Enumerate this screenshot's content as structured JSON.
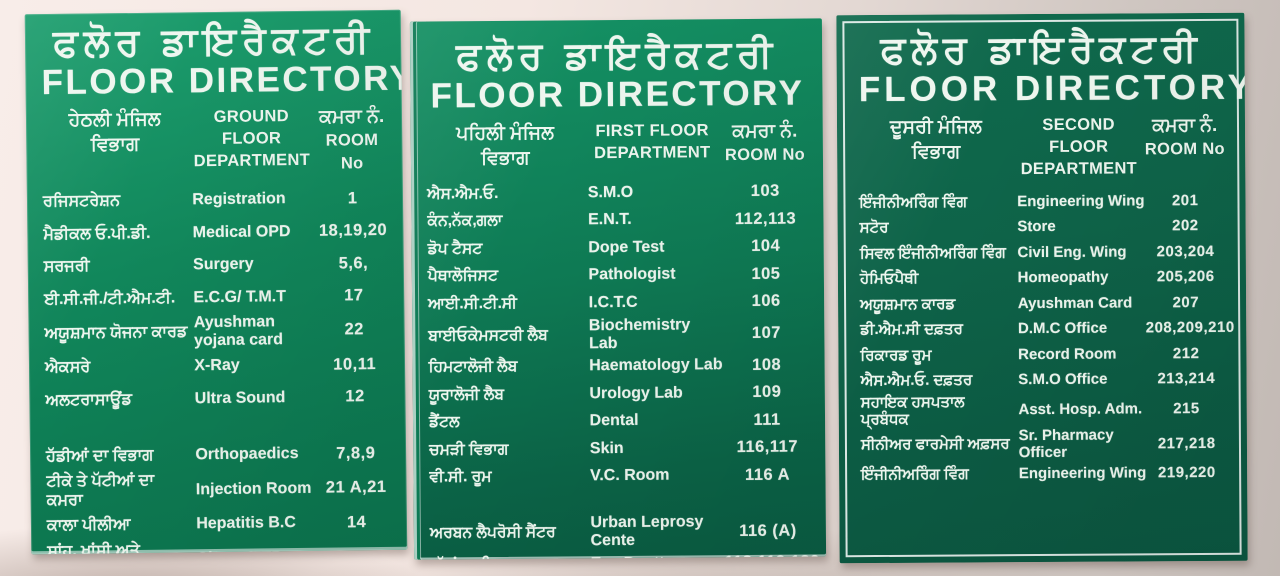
{
  "colors": {
    "board1_green": "#11875b",
    "board2_green": "#0e7a54",
    "board3_green": "#0c5b43",
    "text_white": "#eef6ef",
    "wall_pink": "#f4e7e2"
  },
  "boards": [
    {
      "title_punjabi": "ਫਲੋਰ ਡਾਇਰੈਕਟਰੀ",
      "title_english": "FLOOR DIRECTORY",
      "header": {
        "floor_punjabi": "ਹੇਠਲੀ ਮੰਜਿਲ",
        "dept_punjabi": "ਵਿਭਾਗ",
        "floor_english": "GROUND FLOOR",
        "dept_english": "DEPARTMENT",
        "room_punjabi": "ਕਮਰਾ ਨੰ.",
        "room_english": "ROOM No"
      },
      "rows": [
        {
          "punjabi": "ਰਜਿਸਟਰੇਸ਼ਨ",
          "department": "Registration",
          "room": "1"
        },
        {
          "punjabi": "ਮੈਡੀਕਲ ਓ.ਪੀ.ਡੀ.",
          "department": "Medical OPD",
          "room": "18,19,20"
        },
        {
          "punjabi": "ਸਰਜਰੀ",
          "department": "Surgery",
          "room": "5,6,"
        },
        {
          "punjabi": "ਈ.ਸੀ.ਜੀ./ਟੀ.ਐਮ.ਟੀ.",
          "department": "E.C.G/ T.M.T",
          "room": "17"
        },
        {
          "punjabi": "ਅਯੂਸ਼ਮਾਨ ਯੋਜਨਾ ਕਾਰਡ",
          "department": "Ayushman yojana card",
          "room": "22"
        },
        {
          "punjabi": "ਐਕਸਰੇ",
          "department": "X-Ray",
          "room": "10,11"
        },
        {
          "punjabi": "ਅਲਟਰਾਸਾਊਂਡ",
          "department": "Ultra Sound",
          "room": "12"
        },
        {
          "punjabi": "ਹੱਡੀਆਂ ਦਾ ਵਿਭਾਗ",
          "department": "Orthopaedics",
          "room": "7,8,9",
          "gap_before": true
        },
        {
          "punjabi": "ਟੀਕੇ ਤੇ ਪੱਟੀਆਂ ਦਾ ਕਮਰਾ",
          "department": "Injection Room",
          "room": "21 A,21"
        },
        {
          "punjabi": "ਕਾਲਾ ਪੀਲੀਆ",
          "department": "Hepatitis B.C",
          "room": "14"
        },
        {
          "punjabi": "ਸਾਂਹ, ਖਾਂਸੀ ਅਤੇ\nਟੀ.ਬੀ. ਦੇ ਰੋਗ",
          "department": "Chest & TB",
          "room": ""
        }
      ]
    },
    {
      "title_punjabi": "ਫਲੋਰ ਡਾਇਰੈਕਟਰੀ",
      "title_english": "FLOOR DIRECTORY",
      "header": {
        "floor_punjabi": "ਪਹਿਲੀ ਮੰਜਿਲ",
        "dept_punjabi": "ਵਿਭਾਗ",
        "floor_english": "FIRST FLOOR",
        "dept_english": "DEPARTMENT",
        "room_punjabi": "ਕਮਰਾ ਨੰ.",
        "room_english": "ROOM No"
      },
      "rows": [
        {
          "punjabi": "ਐਸ.ਐਮ.ਓ.",
          "department": "S.M.O",
          "room": "103"
        },
        {
          "punjabi": "ਕੰਨ,ਨੱਕ,ਗਲਾ",
          "department": "E.N.T.",
          "room": "112,113"
        },
        {
          "punjabi": "ਡੋਪ ਟੈਸਟ",
          "department": "Dope Test",
          "room": "104"
        },
        {
          "punjabi": "ਪੈਥਾਲੋਜਿਸਟ",
          "department": "Pathologist",
          "room": "105"
        },
        {
          "punjabi": "ਆਈ.ਸੀ.ਟੀ.ਸੀ",
          "department": "I.C.T.C",
          "room": "106"
        },
        {
          "punjabi": "ਬਾਈਓਕੇਮਸਟਰੀ ਲੈਬ",
          "department": "Biochemistry Lab",
          "room": "107"
        },
        {
          "punjabi": "ਹਿਮਟਾਲੋਜੀ ਲੈਬ",
          "department": "Haematology Lab",
          "room": "108"
        },
        {
          "punjabi": "ਯੂਰਾਲੋਜੀ ਲੈਬ",
          "department": "Urology Lab",
          "room": "109"
        },
        {
          "punjabi": "ਡੈਂਟਲ",
          "department": "Dental",
          "room": "111"
        },
        {
          "punjabi": "ਚਮੜੀ ਵਿਭਾਗ",
          "department": "Skin",
          "room": "116,117"
        },
        {
          "punjabi": "ਵੀ.ਸੀ. ਰੂਮ",
          "department": "V.C. Room",
          "room": "116 A"
        },
        {
          "punjabi": "ਅਰਬਨ ਲੈਪਰੋਸੀ ਸੈਂਟਰ",
          "department": "Urban Leprosy Cente",
          "room": "116 (A)",
          "gap_before": true
        },
        {
          "punjabi": "ਅੱਖਾਂ ਦਾ ਵਿਭਾਗ",
          "department": "Eye Deptt",
          "room": "118,119,120"
        }
      ]
    },
    {
      "title_punjabi": "ਫਲੋਰ ਡਾਇਰੈਕਟਰੀ",
      "title_english": "FLOOR DIRECTORY",
      "header": {
        "floor_punjabi": "ਦੂਸਰੀ ਮੰਜਿਲ",
        "dept_punjabi": "ਵਿਭਾਗ",
        "floor_english": "SECOND FLOOR",
        "dept_english": "DEPARTMENT",
        "room_punjabi": "ਕਮਰਾ ਨੰ.",
        "room_english": "ROOM No"
      },
      "rows": [
        {
          "punjabi": "ਇੰਜੀਨੀਅਰਿੰਗ ਵਿੰਗ",
          "department": "Engineering Wing",
          "room": "201"
        },
        {
          "punjabi": "ਸਟੋਰ",
          "department": "Store",
          "room": "202"
        },
        {
          "punjabi": "ਸਿਵਲ ਇੰਜੀਨੀਅਰਿੰਗ ਵਿੰਗ",
          "department": "Civil Eng. Wing",
          "room": "203,204"
        },
        {
          "punjabi": "ਹੋਮਿਓਪੈਥੀ",
          "department": "Homeopathy",
          "room": "205,206"
        },
        {
          "punjabi": "ਅਯੂਸ਼ਮਾਨ ਕਾਰਡ",
          "department": "Ayushman Card",
          "room": "207"
        },
        {
          "punjabi": "ਡੀ.ਐਮ.ਸੀ ਦਫ਼ਤਰ",
          "department": "D.M.C Office",
          "room": "208,209,210"
        },
        {
          "punjabi": "ਰਿਕਾਰਡ ਰੂਮ",
          "department": "Record Room",
          "room": "212"
        },
        {
          "punjabi": "ਐਸ.ਐਮ.ਓ. ਦਫ਼ਤਰ",
          "department": "S.M.O Office",
          "room": "213,214"
        },
        {
          "punjabi": "ਸਹਾਇਕ ਹਸਪਤਾਲ ਪ੍ਰਬੰਧਕ",
          "department": "Asst. Hosp. Adm.",
          "room": "215"
        },
        {
          "punjabi": "ਸੀਨੀਅਰ ਫਾਰਮੇਸੀ ਅਫ਼ਸਰ",
          "department": "Sr. Pharmacy Officer",
          "room": "217,218"
        },
        {
          "punjabi": "ਇੰਜੀਨੀਅਰਿੰਗ ਵਿੰਗ",
          "department": "Engineering Wing",
          "room": "219,220"
        }
      ]
    }
  ]
}
